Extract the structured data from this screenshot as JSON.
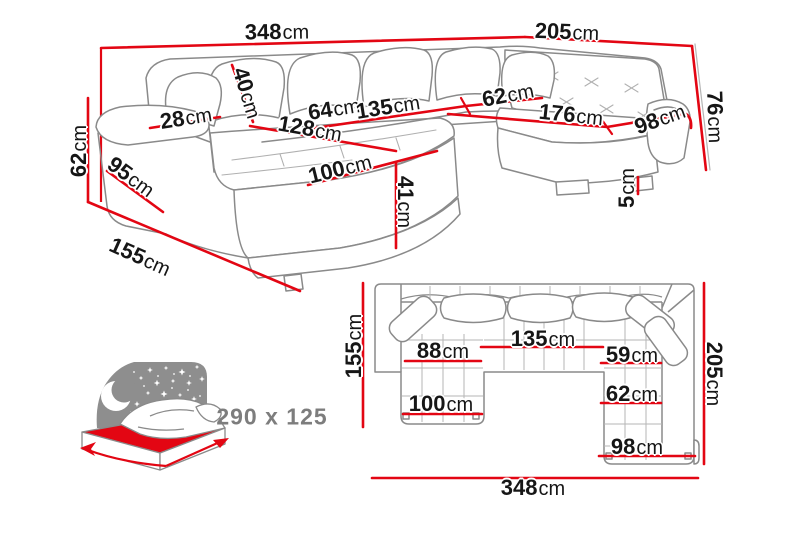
{
  "colors": {
    "dimension_red": "#e30613",
    "sketch_gray": "#8a8a8a",
    "label_black": "#161616",
    "sleeping_gray": "#7d7d7d",
    "background": "#ffffff"
  },
  "perspective_view": {
    "labels": [
      {
        "value": "348",
        "unit": "cm"
      },
      {
        "value": "205",
        "unit": "cm"
      },
      {
        "value": "76",
        "unit": "cm"
      },
      {
        "value": "62",
        "unit": "cm"
      },
      {
        "value": "95",
        "unit": "cm"
      },
      {
        "value": "155",
        "unit": "cm"
      },
      {
        "value": "28",
        "unit": "cm"
      },
      {
        "value": "40",
        "unit": "cm"
      },
      {
        "value": "64",
        "unit": "cm"
      },
      {
        "value": "135",
        "unit": "cm"
      },
      {
        "value": "128",
        "unit": "cm"
      },
      {
        "value": "100",
        "unit": "cm"
      },
      {
        "value": "41",
        "unit": "cm"
      },
      {
        "value": "62",
        "unit": "cm"
      },
      {
        "value": "176",
        "unit": "cm"
      },
      {
        "value": "98",
        "unit": "cm"
      },
      {
        "value": "5",
        "unit": "cm"
      }
    ]
  },
  "plan_view": {
    "labels": [
      {
        "value": "155",
        "unit": "cm"
      },
      {
        "value": "88",
        "unit": "cm"
      },
      {
        "value": "135",
        "unit": "cm"
      },
      {
        "value": "59",
        "unit": "cm"
      },
      {
        "value": "205",
        "unit": "cm"
      },
      {
        "value": "100",
        "unit": "cm"
      },
      {
        "value": "62",
        "unit": "cm"
      },
      {
        "value": "98",
        "unit": "cm"
      },
      {
        "value": "348",
        "unit": "cm"
      }
    ]
  },
  "sleeping_area": {
    "label": "290 x 125"
  }
}
